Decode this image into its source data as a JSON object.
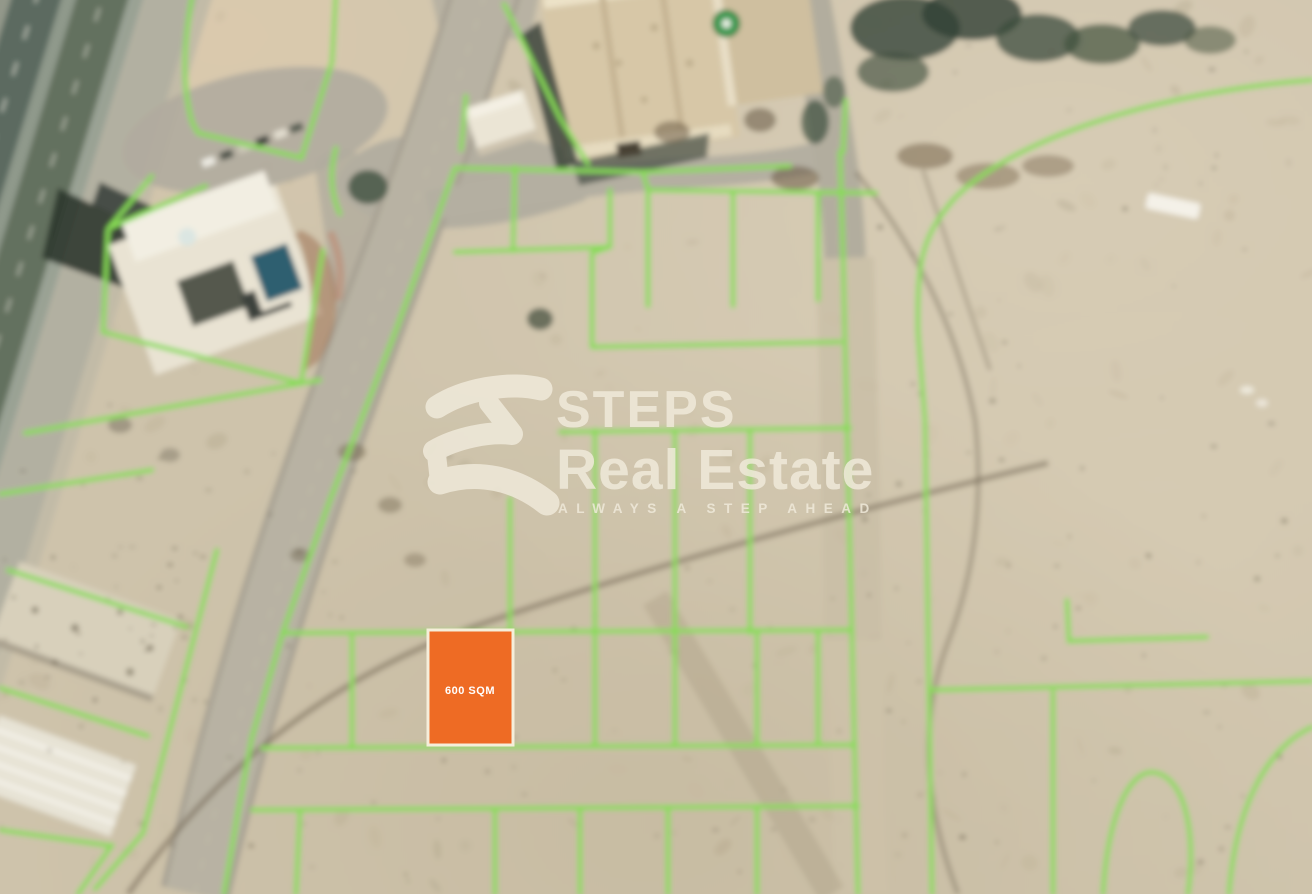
{
  "watermark": {
    "brand_line1": "STEPS",
    "brand_line2": "Real Estate",
    "tagline": "ALWAYS A STEP AHEAD",
    "color": "#F0EADB"
  },
  "overlay": {
    "plot_area_label": "600 SQM",
    "plot_fill": "#EE6B24",
    "plot_border": "#F5EEDA",
    "label_color": "#FFFFFF"
  },
  "map": {
    "parcel_line_color": "#87DC55",
    "sand_color": "#CEC3AB",
    "road_color": "#B8B2A3",
    "highway_color": "#5C6A60"
  }
}
